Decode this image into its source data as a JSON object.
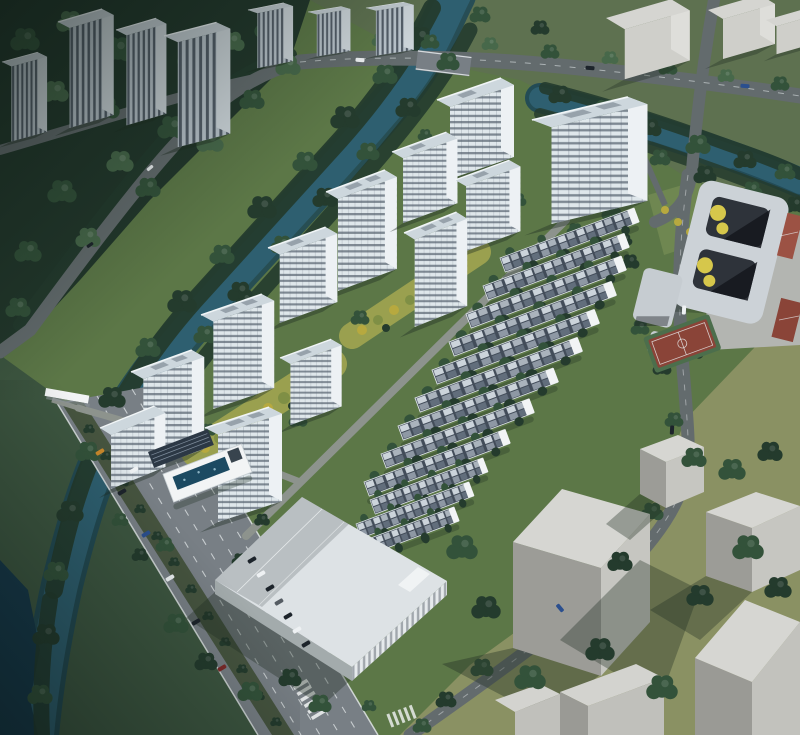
{
  "meta": {
    "title": "Residential development aerial rendering",
    "type": "architectural-birdseye-render",
    "image_size": "800x735"
  },
  "scene": {
    "description": "Bird's-eye architectural rendering of a residential master plan: white mid-rise apartment towers and twelve rows of dark-roofed townhouses set in green landscaping with yellow-foliage garden axes, bounded by a tree-lined river to the north-west, a multi-lane arterial road to the south-west, a school campus with red sports courts to the east, and plain grey context massing blocks on olive lawn to the south-east.",
    "regions": {
      "northwest": "dark forest with existing high-rise towers and a curving river with dense tree banks",
      "north": "road bridge crossing the river, tree-lined avenue, grey context blocks",
      "center_west": "twelve white residential towers in staggered diagonal rows",
      "center_east": "twelve diagonal rows of townhouses with navy roofs and white end walls",
      "landscape": "two yellow-green planting axes between the tower rows",
      "south": "large white-roofed commercial building, clubhouse with solar roof and swimming pool",
      "southwest": "eight-lane arterial road with planted median, gate, crosswalks and cars",
      "east": "school campus with two courtyards and red basketball / tennis courts",
      "southeast": "grey massing cubes casting long shadows on olive lawn"
    },
    "counts": {
      "residential_towers": 12,
      "townhouse_rows": 12,
      "context_towers": 7,
      "context_massing_blocks": 9
    }
  },
  "palette": {
    "water": "#2e5f70",
    "waterDeep": "#16384a",
    "waterEdge": "#1d4756",
    "forest": "#22372b",
    "lawn": "#5c7747",
    "lawnLight": "#6f8751",
    "lawnYellow": "#9aa04f",
    "lawnOlive": "#8a9163",
    "lawnWest": "#3d5640",
    "lawnNorth": "#5e7150",
    "treeDark": "#243b2d",
    "treeMid": "#33523a",
    "treeLight": "#47684a",
    "treeYellow": "#b7a93f",
    "treeYellowGreen": "#7f8f45",
    "roadMain": "#787f85",
    "roadMinor": "#636b6d",
    "roadPath": "#8d938d",
    "laneLine": "#e8ecee",
    "towerRoof": "#cdd7dd",
    "towerFront": "#dfe7eb",
    "towerEnd": "#edf1f4",
    "towerWindow": "#55616e",
    "ctxFacade": "#b9c3cb",
    "ctxStripe": "#39444f",
    "ctxRoof": "#c3ccd2",
    "massTop": "#d5d5d1",
    "massLit": "#cfcfca",
    "massSide": "#9b9b96",
    "thRoof": "#424c59",
    "thTrim": "#dde3e8",
    "white": "#f2f4f5",
    "pool": "#1c4a62",
    "solar": "#2c3845",
    "courtRed": "#9c5244",
    "courtRed2": "#8a4438",
    "courtGreen": "#4c6e4c",
    "yellowAccent": "#d6c74b",
    "shadow": "#1f2e22",
    "carDark": "#1d242b",
    "carWhite": "#eef1f3",
    "carBlue": "#2b4f8e",
    "carOrange": "#c8872b",
    "carRed": "#7e2a2a"
  }
}
